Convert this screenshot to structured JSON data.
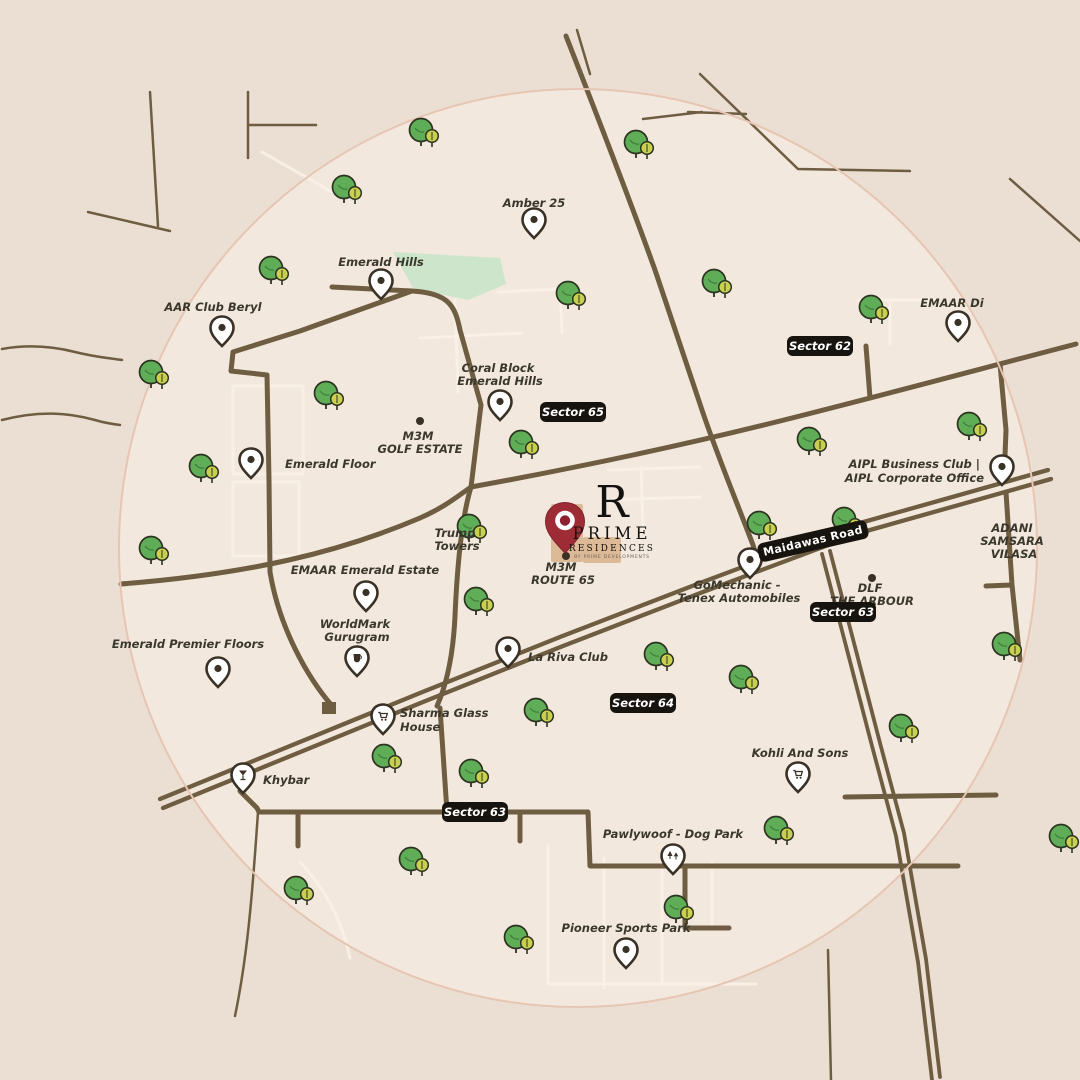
{
  "colors": {
    "background": "#ebdfd4",
    "map_circle": "#f2e8dd",
    "circle_ring": "#e7c5b3",
    "road": "#6e5d41",
    "minor_road": "#f9f1e7",
    "badge": "#17130f",
    "tree_green": "#5fae57",
    "tree_small": "#c9d050",
    "park": "#c9e4c9",
    "building": "#dcb997",
    "brand_red": "#9e2c37",
    "label": "#3a372d"
  },
  "logo": {
    "mark": "R",
    "name_line1": "PRIME",
    "name_line2": "RESIDENCES",
    "tagline": "BY PRIME DEVELOPMENTS"
  },
  "road_label": "Maidawas Road",
  "sector_badges": [
    "Sector 65",
    "Sector 62",
    "Sector 63",
    "Sector 64",
    "Sector 63"
  ],
  "places": [
    {
      "id": "amber-25",
      "lines": [
        "Amber 25"
      ],
      "icon": "pin-dot"
    },
    {
      "id": "emerald-hills",
      "lines": [
        "Emerald Hills"
      ],
      "icon": "pin-dot"
    },
    {
      "id": "aar-club-beryl",
      "lines": [
        "AAR Club Beryl"
      ],
      "icon": "pin-dot"
    },
    {
      "id": "coral-block-emerald-hills",
      "lines": [
        "Coral Block",
        "Emerald Hills"
      ],
      "icon": "pin-dot"
    },
    {
      "id": "emaar-di",
      "lines": [
        "EMAAR Di"
      ],
      "icon": "pin-dot"
    },
    {
      "id": "m3m-golf-estate",
      "lines": [
        "M3M",
        "GOLF ESTATE"
      ],
      "icon": "dot"
    },
    {
      "id": "emerald-floor",
      "lines": [
        "Emerald Floor"
      ],
      "icon": "pin-dot"
    },
    {
      "id": "trump-towers",
      "lines": [
        "Trump",
        "Towers"
      ],
      "icon": "none"
    },
    {
      "id": "emaar-emerald-estate",
      "lines": [
        "EMAAR Emerald Estate"
      ],
      "icon": "pin-dot"
    },
    {
      "id": "m3m-route-65",
      "lines": [
        "M3M",
        "ROUTE 65"
      ],
      "icon": "dot"
    },
    {
      "id": "aipl-business-club",
      "lines": [
        "AIPL Business Club |",
        "AIPL Corporate Office"
      ],
      "icon": "pin-dot"
    },
    {
      "id": "adani-samsara-vilasa",
      "lines": [
        "ADANI",
        "SAMSARA",
        "VILASA"
      ],
      "icon": "none"
    },
    {
      "id": "gomechanic-tenex",
      "lines": [
        "GoMechanic -",
        "Tenex Automobiles"
      ],
      "icon": "pin-dot"
    },
    {
      "id": "dlf-the-arbour",
      "lines": [
        "DLF",
        "THE ARBOUR"
      ],
      "icon": "dot"
    },
    {
      "id": "worldmark-gurugram",
      "lines": [
        "WorldMark",
        "Gurugram"
      ],
      "icon": "pin-cup"
    },
    {
      "id": "emerald-premier-floors",
      "lines": [
        "Emerald Premier Floors"
      ],
      "icon": "pin-dot"
    },
    {
      "id": "la-riva-club",
      "lines": [
        "La Riva Club"
      ],
      "icon": "pin-dot"
    },
    {
      "id": "sharma-glass-house",
      "lines": [
        "Sharma Glass",
        "House"
      ],
      "icon": "pin-cart"
    },
    {
      "id": "khybar",
      "lines": [
        "Khybar"
      ],
      "icon": "pin-glass"
    },
    {
      "id": "kohli-and-sons",
      "lines": [
        "Kohli And Sons"
      ],
      "icon": "pin-cart"
    },
    {
      "id": "pawlywoof-dog-park",
      "lines": [
        "Pawlywoof - Dog Park"
      ],
      "icon": "pin-trees"
    },
    {
      "id": "pioneer-sports-park",
      "lines": [
        "Pioneer Sports Park"
      ],
      "icon": "pin-dot"
    }
  ]
}
